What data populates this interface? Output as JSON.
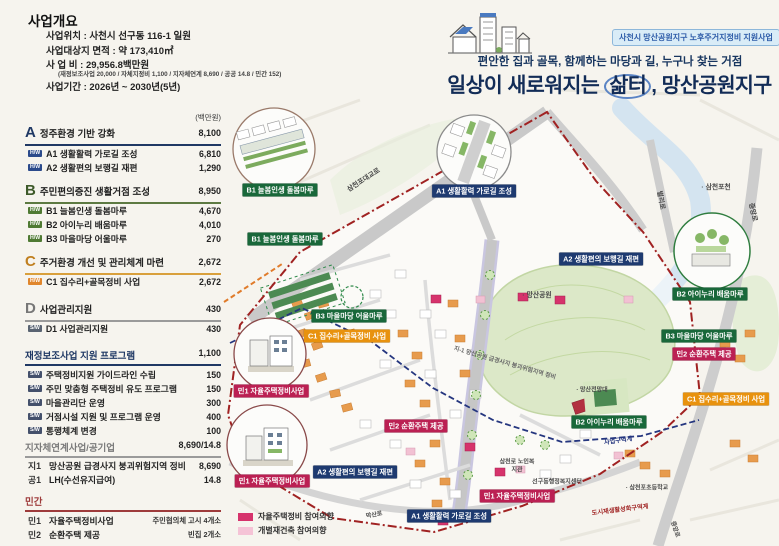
{
  "header": {
    "badge": "사천시 망산공원지구 노후주거지정비 지원사업",
    "subtitle": "편안한 집과 골목, 함께하는 마당과 길, 누구나 찾는 거점",
    "title_pre": "일상이 새로워지는 ",
    "title_circled": "삶터",
    "title_post": ", 망산공원지구"
  },
  "overview": {
    "title": "사업개요",
    "location": "사업위치 : 사천시 선구동 116-1 일원",
    "area": "사업대상지 면적 : 약 173,410㎡",
    "cost": "사 업 비 : 29,956.8백만원",
    "cost_detail": "(재정보조사업 20,000 / 자체지정비 1,100 / 지자체연계 8,690 / 공공 14.8 / 민간 152)",
    "period": "사업기간 : 2026년 ~ 2030년(5년)"
  },
  "budget": {
    "unit": "(백만원)",
    "sections": [
      {
        "code": "A",
        "title": "정주환경 기반 강화",
        "total": "8,100",
        "items": [
          {
            "badge": "H/W",
            "label": "A1 생활활력 가로길 조성",
            "value": "6,810"
          },
          {
            "badge": "H/W",
            "label": "A2 생활편의 보행길 재편",
            "value": "1,290"
          }
        ]
      },
      {
        "code": "B",
        "title": "주민편의증진 생활거점 조성",
        "total": "8,950",
        "items": [
          {
            "badge": "H/W",
            "label": "B1 늘봄인생 돌봄마루",
            "value": "4,670"
          },
          {
            "badge": "H/W",
            "label": "B2 아이누리 배움마루",
            "value": "4,010"
          },
          {
            "badge": "H/W",
            "label": "B3 마을마당 어울마루",
            "value": "270"
          }
        ]
      },
      {
        "code": "C",
        "title": "주거환경 개선 및 관리체계 마련",
        "total": "2,672",
        "items": [
          {
            "badge": "H/W",
            "label": "C1 집수리+골목정비 사업",
            "value": "2,672"
          }
        ]
      },
      {
        "code": "D",
        "title": "사업관리지원",
        "total": "430",
        "items": [
          {
            "badge": "S/W",
            "label": "D1 사업관리지원",
            "value": "430"
          }
        ]
      }
    ],
    "program": {
      "title": "재정보조사업 지원 프로그램",
      "total": "1,100",
      "items": [
        {
          "badge": "S/W",
          "label": "주택정비지원 가이드라인 수립",
          "value": "150"
        },
        {
          "badge": "S/W",
          "label": "주민 맞춤형 주택정비 유도 프로그램",
          "value": "150"
        },
        {
          "badge": "S/W",
          "label": "마을관리단 운영",
          "value": "300"
        },
        {
          "badge": "S/W",
          "label": "거점시설 지원 및 프로그램 운영",
          "value": "400"
        },
        {
          "badge": "S/W",
          "label": "통행체계 변경",
          "value": "100"
        }
      ]
    },
    "linked": {
      "title": "지자체연계사업/공기업",
      "total": "8,690/14.8",
      "items": [
        {
          "code": "지1",
          "label": "망산공원 급경사지 붕괴위험지역 정비",
          "value": "8,690"
        },
        {
          "code": "공1",
          "label": "LH(수선유지급여)",
          "value": "14.8"
        }
      ]
    },
    "private": {
      "title": "민간",
      "items": [
        {
          "code": "민1",
          "label": "자율주택정비사업",
          "value": "주민협의체 고시 4개소"
        },
        {
          "code": "민2",
          "label": "순환주택 제공",
          "value": "빈집 2개소"
        }
      ]
    }
  },
  "map": {
    "labels": [
      "B1 늘봄인생 돌봄마루",
      "A1 생활활력 가로길 조성",
      "B2 아이누리 배움마루",
      "민1 자율주택정비사업",
      "민1 자율주택정비사업",
      "B1 늘봄인생 돌봄마루",
      "A2 생활편의 보행길 재편",
      "B3 마을마당 어울마루",
      "C1 집수리+골목정비 사업",
      "민2 순환주택 제공",
      "A2 생활편의 보행길 재편",
      "민1 자율주택정비사업",
      "A1 생활활력 가로길 조성",
      "B2 아이누리 배움마루",
      "C1 집수리+골목정비 사업",
      "B3 마을마당 어울마루",
      "민2 순환주택 제공"
    ],
    "places": [
      "삼천포대교로",
      "· 삼천포천",
      "벌리로",
      "중앙로",
      "· 망산공원",
      "지-1 망산공원 급경사지 붕괴위험지역 정비",
      "· 망산전망대",
      "삼천로 노인복지관",
      "선구동행정복지센터",
      "· 삼천포초등학교",
      "사업구역계",
      "도시재생활성화구역계",
      "막산로",
      "중앙로"
    ],
    "legend": [
      {
        "label": "자율주택정비 참여의향",
        "color": "#d6336c"
      },
      {
        "label": "개별재건축 참여의향",
        "color": "#f5c3d6"
      }
    ],
    "boundary_color": "#a02222",
    "zone_line_color": "#25367f",
    "park_color": "#dce8c8"
  }
}
